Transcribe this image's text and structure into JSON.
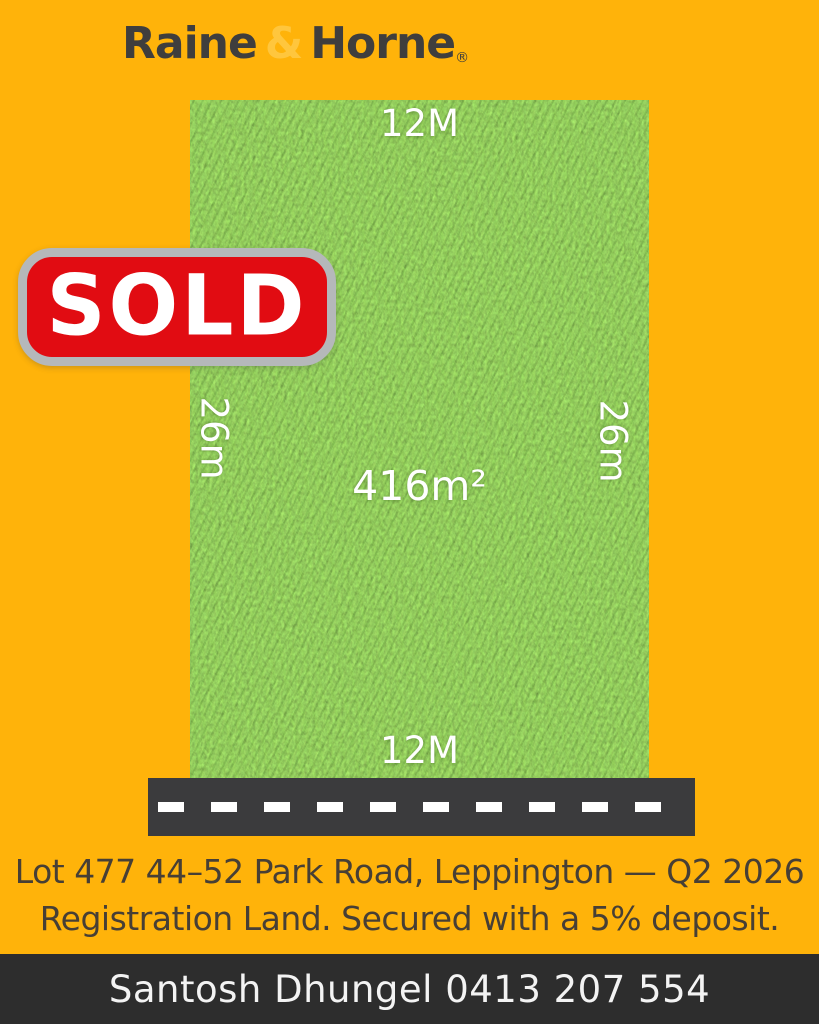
{
  "brand": {
    "name_left": "Raine",
    "ampersand": "&",
    "name_right": "Horne",
    "registered_mark": "®",
    "text_color": "#3f3e3d",
    "ampersand_color": "#ffc63d"
  },
  "colors": {
    "background": "#ffb30a",
    "grass_base": "#4e9422",
    "road": "#3b3b3d",
    "footer_bar": "#2d2d2d",
    "sold_red": "#e10c12",
    "sold_border": "#b5b8ba",
    "dimension_text": "#ffffff",
    "caption_text": "#473f35"
  },
  "lot": {
    "top_width_label": "12M",
    "bottom_width_label": "12M",
    "left_depth_label": "26m",
    "right_depth_label": "26m",
    "area_label": "416m²"
  },
  "sold_badge": {
    "label": "SOLD"
  },
  "caption": {
    "line1": "Lot 477 44–52 Park Road, Leppington — Q2 2026",
    "line2": "Registration Land. Secured with a 5% deposit."
  },
  "footer": {
    "contact": "Santosh Dhungel 0413 207 554"
  }
}
